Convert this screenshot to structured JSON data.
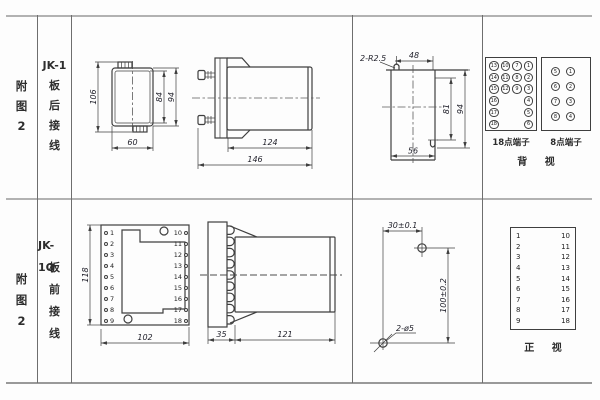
{
  "colors": {
    "line": "#3f3f3f",
    "grid": "#6e6e6e",
    "text": "#2d2d2d"
  },
  "row1": {
    "fig": {
      "c1": "附",
      "c2": "图",
      "c3": "2"
    },
    "model": {
      "c1": "JK-1",
      "c2": "板",
      "c3": "后",
      "c4": "接",
      "c5": "线"
    },
    "rear_view": {
      "dim_total_height": "106",
      "dim_inner_height": "84",
      "dim_outer_height": "94",
      "dim_width": "60"
    },
    "side_view": {
      "dim_body_length": "124",
      "dim_total_length": "146"
    },
    "cutout_view": {
      "slot_label": "2-R2.5",
      "dim_slot_span": "48",
      "dim_inner_height": "81",
      "dim_outer_height": "94",
      "dim_width": "56"
    },
    "terminal18": {
      "label": "18点端子",
      "grid": [
        [
          "13",
          "10",
          "7",
          "1"
        ],
        [
          "14",
          "11",
          "8",
          "2"
        ],
        [
          "15",
          "12",
          "9",
          "3"
        ],
        [
          "16",
          "",
          "",
          "4"
        ],
        [
          "17",
          "",
          "",
          "5"
        ],
        [
          "18",
          "",
          "",
          "6"
        ]
      ]
    },
    "terminal8": {
      "label": "8点端子",
      "grid": [
        [
          "5",
          "1"
        ],
        [
          "6",
          "2"
        ],
        [
          "7",
          "3"
        ],
        [
          "8",
          "4"
        ]
      ]
    },
    "view_label": "背 视"
  },
  "row2": {
    "fig": {
      "c1": "附",
      "c2": "图",
      "c3": "2"
    },
    "model": {
      "c1": "JK-1Q",
      "c2": "板",
      "c3": "前",
      "c4": "接",
      "c5": "线"
    },
    "front_view": {
      "dim_height": "118",
      "dim_width": "102",
      "left_terminals": [
        "1",
        "2",
        "3",
        "4",
        "5",
        "6",
        "7",
        "8",
        "9"
      ],
      "right_terminals": [
        "10",
        "11",
        "12",
        "13",
        "14",
        "15",
        "16",
        "17",
        "18"
      ]
    },
    "side_view": {
      "dim_plate": "35",
      "dim_body": "121"
    },
    "drill_view": {
      "dim_horizontal": "30±0.1",
      "dim_vertical": "100±0.2",
      "hole_label": "2-ø5"
    },
    "terminal_front": {
      "left": [
        "1",
        "2",
        "3",
        "4",
        "5",
        "6",
        "7",
        "8",
        "9"
      ],
      "right": [
        "10",
        "11",
        "12",
        "13",
        "14",
        "15",
        "16",
        "17",
        "18"
      ],
      "label": "正 视"
    }
  }
}
